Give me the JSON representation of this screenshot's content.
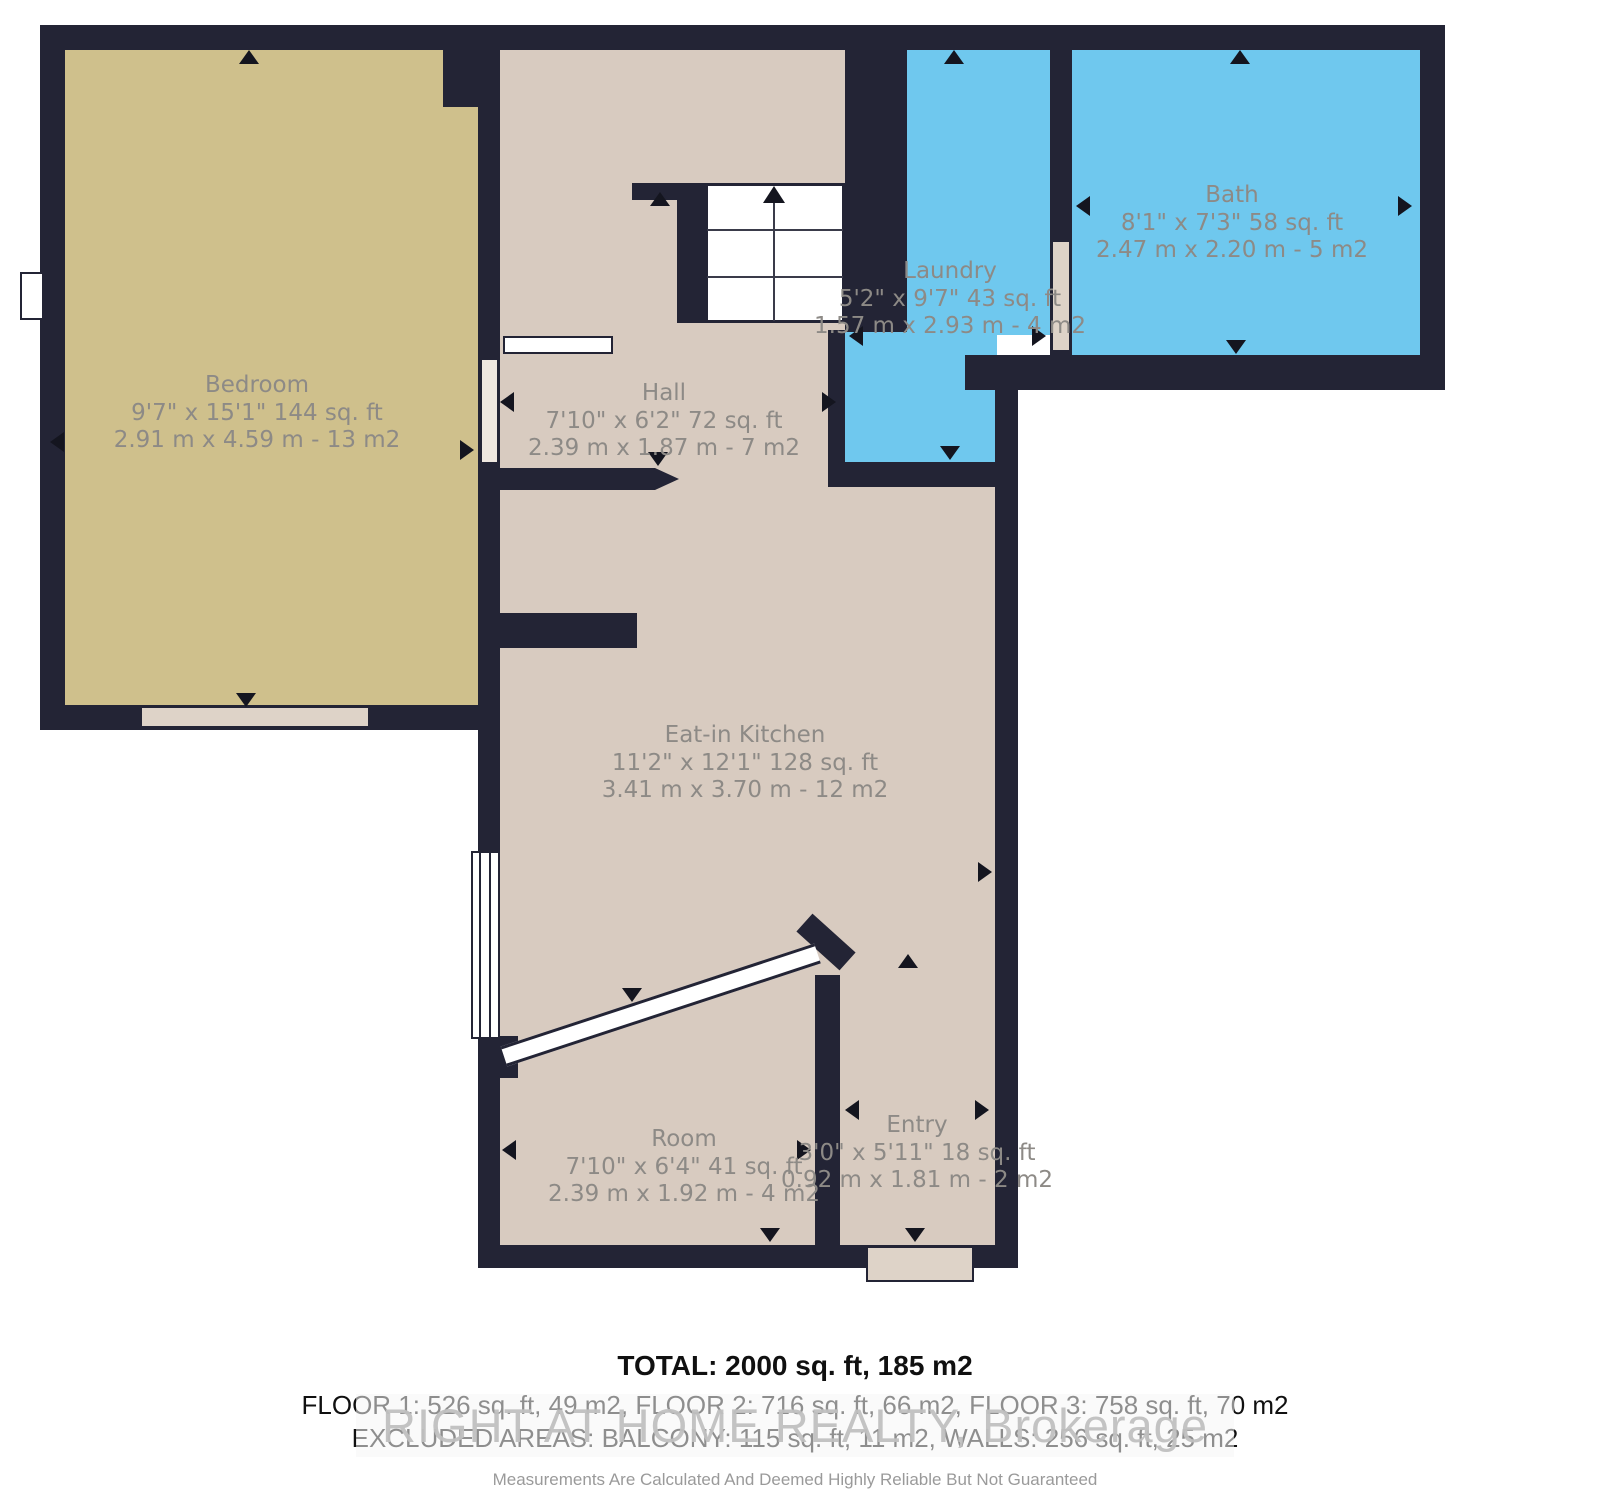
{
  "plan": {
    "type": "floorplan",
    "colors": {
      "wall": "#232435",
      "bedroom_floor": "#cfc08c",
      "living_floor": "#d8cbc0",
      "wet_room_floor": "#6fc8ee",
      "label_text": "#8d8a86",
      "footer_text": "#101010",
      "watermark_text": "#c0c0c0"
    },
    "rooms": [
      {
        "id": "bedroom",
        "name": "Bedroom",
        "imperial": "9'7\" x 15'1\" 144 sq. ft",
        "metric": "2.91 m x 4.59 m - 13 m2"
      },
      {
        "id": "hall",
        "name": "Hall",
        "imperial": "7'10\" x 6'2\" 72 sq. ft",
        "metric": "2.39 m x 1.87 m - 7 m2"
      },
      {
        "id": "laundry",
        "name": "Laundry",
        "imperial": "5'2\" x 9'7\" 43 sq. ft",
        "metric": "1.57 m x 2.93 m - 4 m2"
      },
      {
        "id": "bath",
        "name": "Bath",
        "imperial": "8'1\" x 7'3\" 58 sq. ft",
        "metric": "2.47 m x 2.20 m - 5 m2"
      },
      {
        "id": "kitchen",
        "name": "Eat-in Kitchen",
        "imperial": "11'2\" x 12'1\" 128 sq. ft",
        "metric": "3.41 m x 3.70 m - 12 m2"
      },
      {
        "id": "room",
        "name": "Room",
        "imperial": "7'10\" x 6'4\" 41 sq. ft",
        "metric": "2.39 m x 1.92 m - 4 m2"
      },
      {
        "id": "entry",
        "name": "Entry",
        "imperial": "3'0\" x 5'11\" 18 sq. ft",
        "metric": "0.92 m x 1.81 m - 2 m2"
      }
    ],
    "footer": {
      "total": "TOTAL: 2000 sq. ft, 185 m2",
      "floors": "FLOOR 1: 526 sq. ft, 49 m2, FLOOR 2: 716 sq. ft, 66 m2, FLOOR 3: 758 sq. ft, 70 m2",
      "excluded": "EXCLUDED AREAS: BALCONY: 115 sq. ft, 11 m2, WALLS: 256 sq. ft, 25 m2",
      "watermark": "RIGHT AT HOME REALTY, Brokerage",
      "disclaimer": "Measurements Are Calculated And Deemed Highly Reliable But Not Guaranteed"
    }
  }
}
